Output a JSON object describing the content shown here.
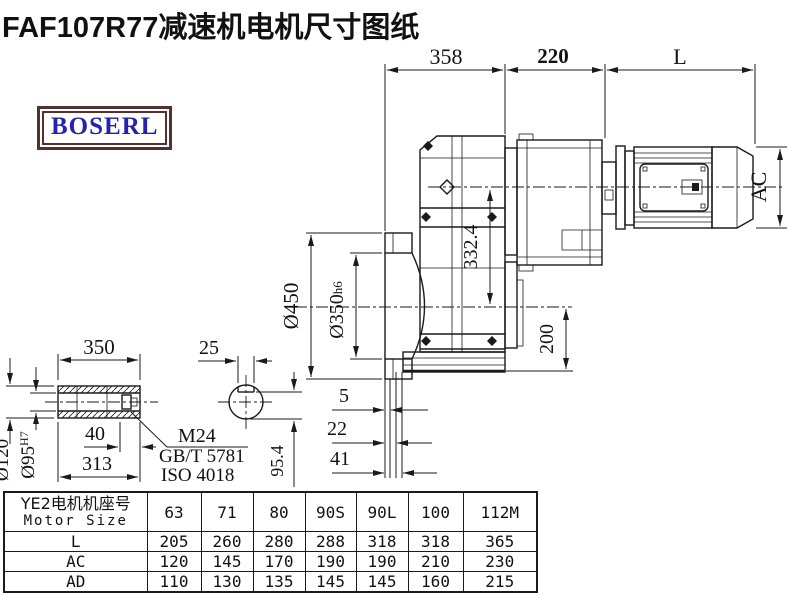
{
  "title": "FAF107R77减速机电机尺寸图纸",
  "logo": "BOSERL",
  "colors": {
    "line": "#1a1a1a",
    "logo_text": "#2323ae",
    "logo_border": "#553030"
  },
  "main_view": {
    "dim_overall": "358",
    "dim_adapter": "220",
    "dim_motor_length": "L",
    "dim_motor_diameter": "AC",
    "dim_flange_od": "Ø450",
    "dim_flange_pilot": "Ø350",
    "dim_flange_pilot_tol": "h6",
    "dim_axis": "332.4",
    "dim_base": "200",
    "dim_offset_1": "5",
    "dim_offset_2": "22",
    "dim_offset_3": "41"
  },
  "shaft_view": {
    "dim_length": "350",
    "dim_keyway": "25",
    "dim_od": "Ø120",
    "dim_bore": "Ø95",
    "dim_bore_tol": "H7",
    "dim_thread_depth": "40",
    "dim_body": "313",
    "dim_key_height": "95.4",
    "thread": "M24",
    "standard_1": "GB/T 5781",
    "standard_2": "ISO 4018"
  },
  "table": {
    "header_cn": "YE2电机机座号",
    "header_en": "Motor Size",
    "columns": [
      "63",
      "71",
      "80",
      "90S",
      "90L",
      "100",
      "112M"
    ],
    "rows": [
      {
        "label": "L",
        "values": [
          "205",
          "260",
          "280",
          "288",
          "318",
          "318",
          "365"
        ]
      },
      {
        "label": "AC",
        "values": [
          "120",
          "145",
          "170",
          "190",
          "190",
          "210",
          "230"
        ]
      },
      {
        "label": "AD",
        "values": [
          "110",
          "130",
          "135",
          "145",
          "145",
          "160",
          "215"
        ]
      }
    ]
  }
}
